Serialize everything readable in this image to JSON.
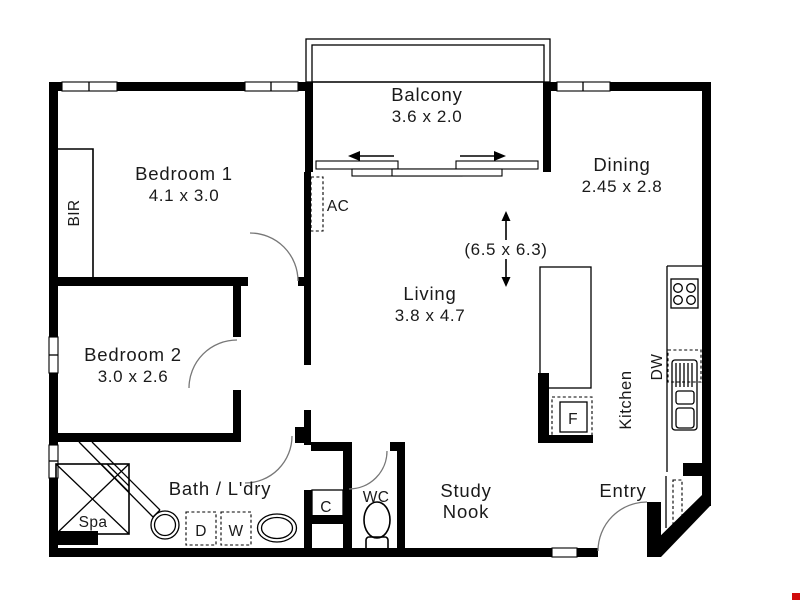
{
  "plan": {
    "rooms": {
      "balcony": {
        "name": "Balcony",
        "size": "3.6 x 2.0"
      },
      "bedroom1": {
        "name": "Bedroom 1",
        "size": "4.1 x 3.0"
      },
      "dining": {
        "name": "Dining",
        "size": "2.45 x 2.8"
      },
      "living": {
        "name": "Living",
        "size": "3.8 x 4.7"
      },
      "bedroom2": {
        "name": "Bedroom 2",
        "size": "3.0 x 2.6"
      },
      "bath_laundry": {
        "name": "Bath / L'dry"
      },
      "study_nook": {
        "line1": "Study",
        "line2": "Nook"
      },
      "entry": {
        "name": "Entry"
      },
      "kitchen": {
        "name": "Kitchen"
      },
      "wc": {
        "name": "WC"
      }
    },
    "overall_size": "(6.5 x 6.3)",
    "fixtures": {
      "built_in_robe": "BIR",
      "air_conditioner": "AC",
      "dishwasher": "DW",
      "fridge": "F",
      "spa": "Spa",
      "dryer": "D",
      "washer": "W",
      "cupboard": "C"
    },
    "colors": {
      "wall": "#000000",
      "text": "#1a1a1a",
      "artifact_red": "#d00c0c"
    }
  }
}
